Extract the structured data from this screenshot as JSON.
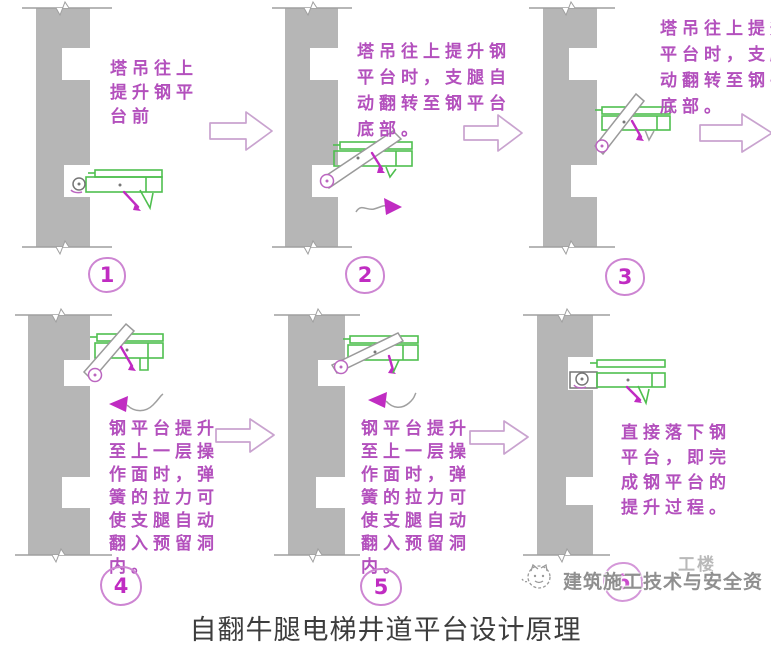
{
  "page": {
    "caption": "自翻牛腿电梯井道平台设计原理",
    "background": "#ffffff"
  },
  "panels": [
    {
      "number": "1",
      "text": "塔吊往上\n提升钢平\n台前"
    },
    {
      "number": "2",
      "text": "塔吊往上提升钢\n平台时，支腿自\n动翻转至钢平台\n底部。"
    },
    {
      "number": "3",
      "text": "塔吊往上提升钢\n平台时，支腿自\n动翻转至钢平台\n底部。"
    },
    {
      "number": "4",
      "text": "钢平台提升\n至上一层操\n作面时，弹\n簧的拉力可\n使支腿自动\n翻入预留洞\n内。"
    },
    {
      "number": "5",
      "text": "钢平台提升\n至上一层操\n作面时，弹\n簧的拉力可\n使支腿自动\n翻入预留洞\n内。"
    },
    {
      "number": "6",
      "text": "直接落下钢\n平台，即完\n成钢平台的\n提升过程。"
    }
  ],
  "watermark": {
    "logo": "cat-logo",
    "text": "建筑施工技术与安全资",
    "fragment": "工楼"
  },
  "icons": {
    "step_arrow": "right-block-arrow",
    "rotate_right": "rotate-arrow-right",
    "rotate_left": "rotate-arrow-left"
  },
  "colors": {
    "annotation": "#b350bd",
    "accent": "#c02cc2",
    "green": "#4fbf4f",
    "wall": "#b6b6b6",
    "arrowline": "#c9a3cf"
  }
}
